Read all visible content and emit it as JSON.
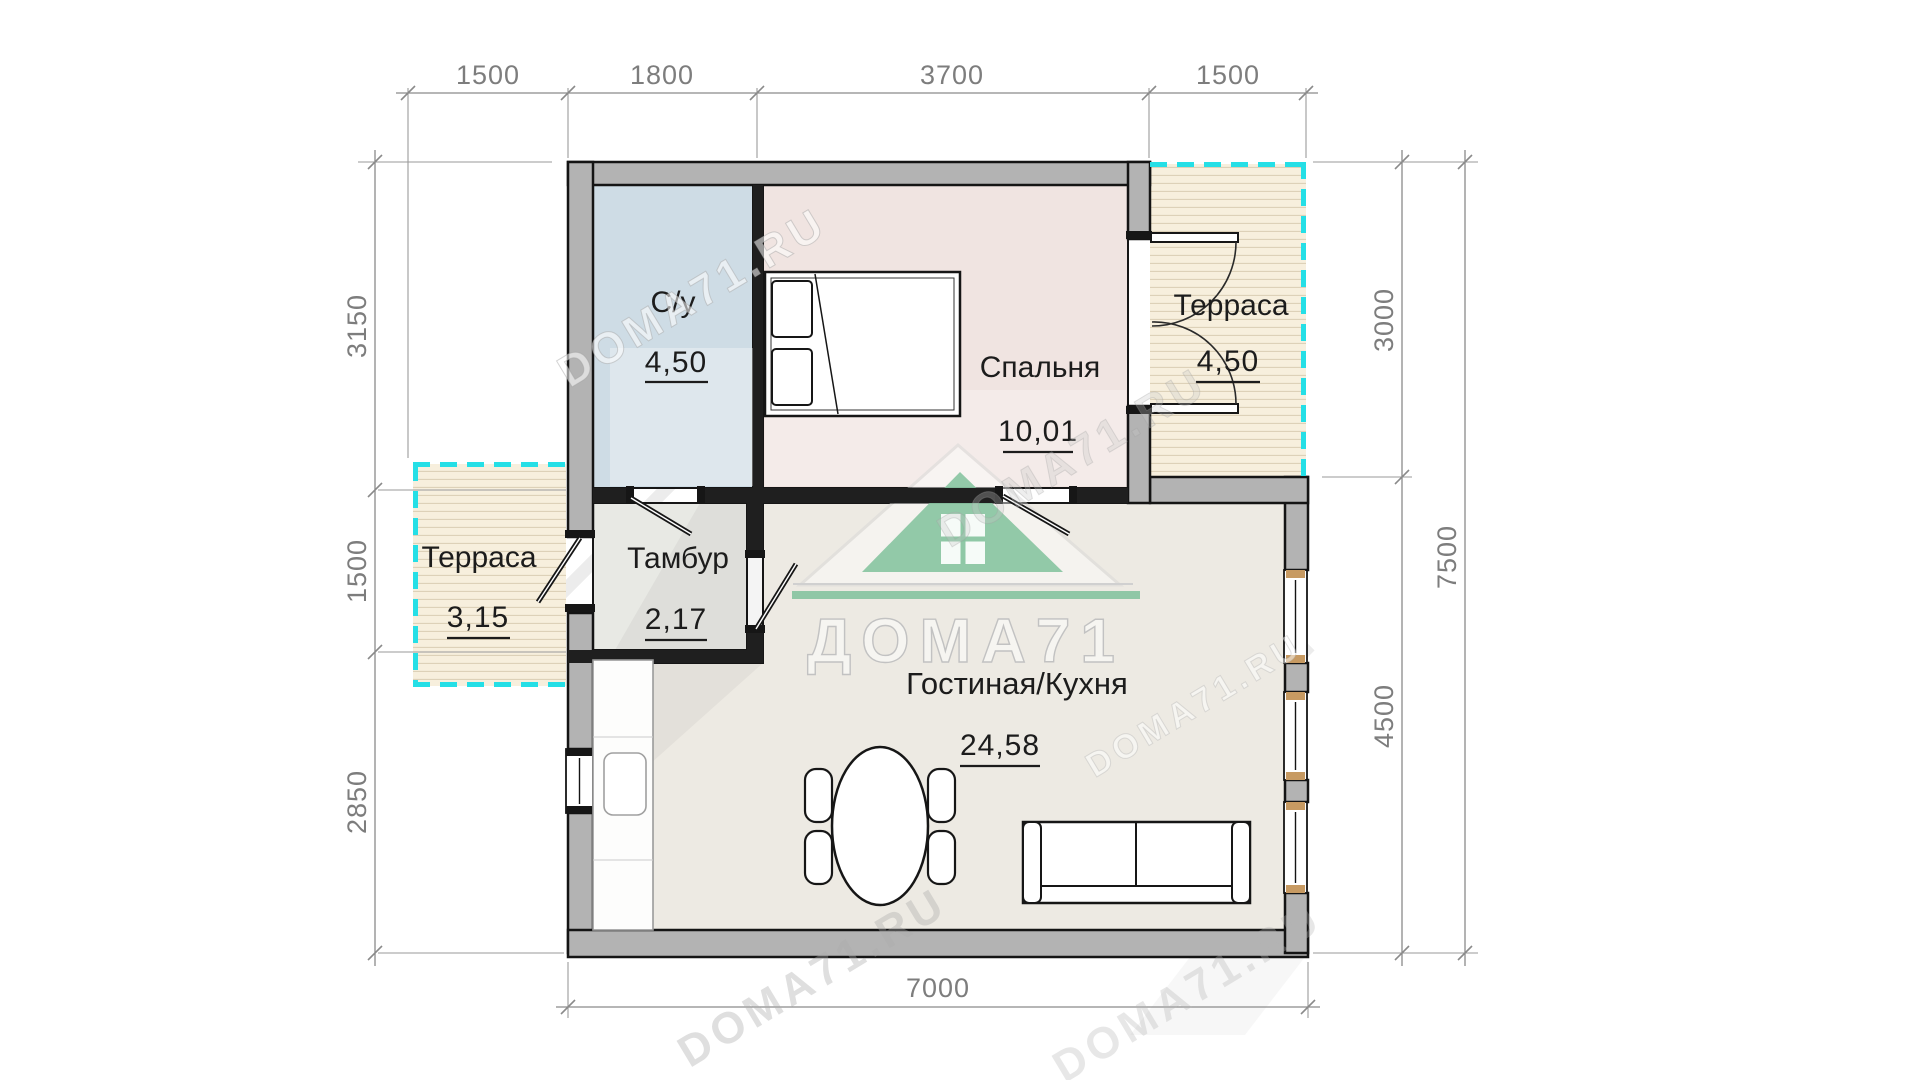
{
  "dimensions": {
    "top": [
      "1500",
      "1800",
      "3700",
      "1500"
    ],
    "left": [
      "3150",
      "1500",
      "2850"
    ],
    "right": [
      "3000",
      "4500"
    ],
    "right_total": [
      "7500"
    ],
    "bottom": [
      "7000"
    ]
  },
  "rooms": [
    {
      "name": "С/у",
      "area": "4,50"
    },
    {
      "name": "Спальня",
      "area": "10,01"
    },
    {
      "name": "Терраса",
      "area": "4,50"
    },
    {
      "name": "Тамбур",
      "area": "2,17"
    },
    {
      "name": "Терраса",
      "area": "3,15"
    },
    {
      "name": "Гостиная/Кухня",
      "area": "24,58"
    }
  ],
  "watermark": {
    "logo": "ДОМА71",
    "url": "DOMA71.RU"
  },
  "colors": {
    "terrace_dash": "#25dfe6",
    "logo_green": "#84c39e",
    "wall_fill": "#b3b3b3",
    "wall_line": "#141414",
    "dim_gray": "#8a8a8a",
    "floor_bath": "#cedce5",
    "floor_bedroom": "#f0e4e1",
    "floor_tambour": "#e8e9e4",
    "floor_living": "#edeae3",
    "floor_terrace": "#f7efdd",
    "window_cap": "#c79a62"
  }
}
